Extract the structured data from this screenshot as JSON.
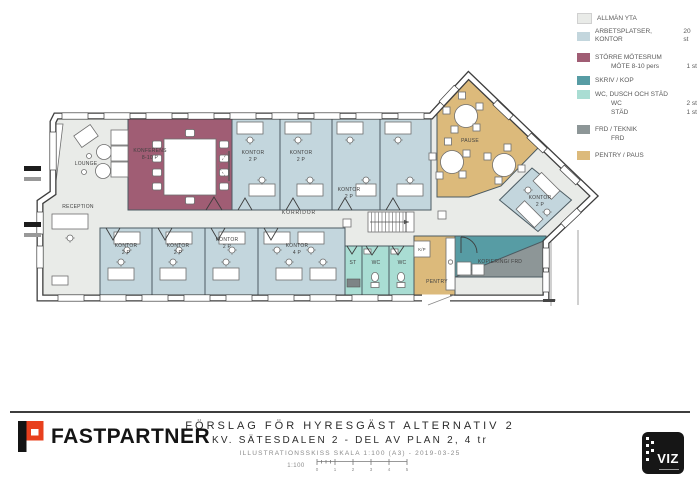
{
  "colors": {
    "allman": "#e9ebe8",
    "kontor": "#c3d6dd",
    "moetesrum": "#a05d74",
    "skrivkop": "#579ca4",
    "wcstad": "#a9ddd3",
    "frd": "#8d9697",
    "pentry": "#dcba7b",
    "wall": "#3d3d3d",
    "brand_red": "#e8401e"
  },
  "legend": {
    "items": [
      {
        "label": "ALLMÄN YTA",
        "count": ""
      },
      {
        "label": "ARBETSPLATSER, KONTOR",
        "count": "20 st"
      },
      {
        "label": "STÖRRE MÖTESRUM",
        "count": "",
        "sub": [
          {
            "label": "MÖTE 8-10 pers",
            "count": "1 st"
          }
        ]
      },
      {
        "label": "SKRIV / KOP",
        "count": ""
      },
      {
        "label": "WC, DUSCH OCH STÄD",
        "count": "",
        "sub": [
          {
            "label": "WC",
            "count": "2 st"
          },
          {
            "label": "STÄD",
            "count": "1 st"
          }
        ]
      },
      {
        "label": "FRD / TEKNIK",
        "count": "",
        "sub": [
          {
            "label": "FRD",
            "count": ""
          }
        ]
      },
      {
        "label": "PENTRY / PAUS",
        "count": ""
      }
    ]
  },
  "plan": {
    "labels": {
      "lounge": "LOUNGE",
      "konferens_name": "KONFERENS",
      "konferens_cap": "8-10 P",
      "kontor": "KONTOR",
      "cap_2p": "2 P",
      "cap_4p": "4 P",
      "reception": "RECEPTION",
      "korridor": "KORRIDOR",
      "pause": "PAUSE",
      "st": "ST",
      "wc": "WC",
      "kp": "K/P",
      "pentry": "PENTRY",
      "kopiering": "KOPIERING/ FRD"
    }
  },
  "title_block": {
    "line1": "FÖRSLAG FÖR HYRESGÄST ALTERNATIV 2",
    "line2": "KV. SÄTESDALEN 2 - DEL AV PLAN 2, 4 tr",
    "line3": "ILLUSTRATIONSSKISS SKALA 1:100 (A3) - 2019-03-25",
    "scale_label": "1:100",
    "scale_ticks": [
      "0",
      "1",
      "2",
      "3",
      "4",
      "5"
    ],
    "brand": "FASTPARTNER",
    "viz_logo": "VIZ"
  }
}
